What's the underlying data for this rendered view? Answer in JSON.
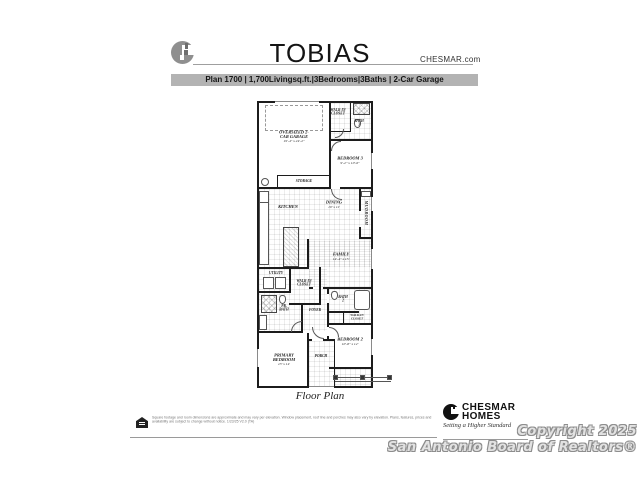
{
  "header": {
    "title": "TOBIAS",
    "website": "CHESMAR.com",
    "logo_icon": "chesmar-c-logo",
    "plan_bar": "Plan 1700 | 1,700Livingsq.ft.|3Bedrooms|3Baths | 2-Car Garage"
  },
  "plan": {
    "caption": "Floor Plan",
    "rooms": {
      "garage": {
        "name": "OVERSIZED 2-CAR GARAGE",
        "dims": "19'-4\" x 24'-2\""
      },
      "storage": {
        "name": "STORAGE"
      },
      "closet3": {
        "name": "WALK-IN CLOSET"
      },
      "bath3": {
        "name": "BATH 3"
      },
      "bedroom3": {
        "name": "BEDROOM 3",
        "dims": "9'-2\" x 10'-6\""
      },
      "kitchen": {
        "name": "KITCHEN"
      },
      "dining": {
        "name": "DINING",
        "dims": "10' x 11'"
      },
      "mudroom": {
        "name": "MUDROOM"
      },
      "family": {
        "name": "FAMILY",
        "dims": "14'-4\" x 15'"
      },
      "utility": {
        "name": "UTILITY"
      },
      "primary_closet": {
        "name": "WALK-IN CLOSET"
      },
      "primary_bath": {
        "name": "PR. BATH"
      },
      "foyer": {
        "name": "FOYER"
      },
      "bath2": {
        "name": "BATH 2"
      },
      "closet2": {
        "name": "WALK-IN CLOSET"
      },
      "bedroom2": {
        "name": "BEDROOM 2",
        "dims": "10'-8\" x 12'"
      },
      "primary_bedroom": {
        "name": "PRIMARY BEDROOM",
        "dims": "13' x 14'"
      },
      "porch": {
        "name": "PORCH"
      }
    }
  },
  "footer": {
    "equal_housing_icon": "equal-housing-logo",
    "disclaimer": "Square footage and room dimensions are approximate and may vary per elevation. Window placement, roof line and porches may also vary by elevation. Plans, features, prices and availability are subject to change without notice. 1/23/25   V2.0 (TA)",
    "brand": {
      "line1": "CHESMAR",
      "line2": "HOMES",
      "tagline": "Setting a Higher Standard"
    },
    "copyright_line1": "Copyright 2025",
    "copyright_line2": "San Antonio Board of Realtors®"
  }
}
